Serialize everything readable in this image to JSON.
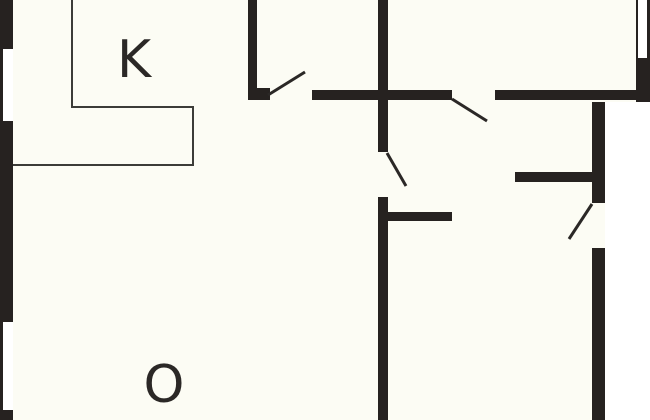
{
  "plan": {
    "title": "floor-plan",
    "canvas": {
      "width": 650,
      "height": 420
    },
    "colors": {
      "background": "#FCFCF4",
      "exterior": "#FFFFFF",
      "wall": "#262220",
      "window_fill": "#FFFFFF",
      "fixture_line": "#3C3C38",
      "door_swing": "#2B2826",
      "label_text": "#2B2826"
    },
    "rooms": [
      {
        "id": "kitchen",
        "label": "K",
        "cx": 134,
        "cy": 60
      },
      {
        "id": "living-room",
        "label": "O",
        "cx": 164,
        "cy": 385
      }
    ],
    "exterior_areas": [
      {
        "name": "outside-right",
        "x": 605,
        "y": 102,
        "w": 45,
        "h": 318
      }
    ],
    "walls": [
      {
        "name": "left-exterior-wall",
        "x": 0,
        "y": 0,
        "w": 13,
        "h": 420
      },
      {
        "name": "top-partition-wall",
        "x": 248,
        "y": 0,
        "w": 9,
        "h": 90
      },
      {
        "name": "top-partition-door-jamb",
        "x": 248,
        "y": 88,
        "w": 22,
        "h": 12
      },
      {
        "name": "center-vertical-wall-upper",
        "x": 378,
        "y": 0,
        "w": 10,
        "h": 152
      },
      {
        "name": "center-vertical-wall-lower",
        "x": 378,
        "y": 197,
        "w": 10,
        "h": 223
      },
      {
        "name": "hall-horizontal-wall-left",
        "x": 312,
        "y": 90,
        "w": 140,
        "h": 10
      },
      {
        "name": "hall-horizontal-wall-right",
        "x": 495,
        "y": 90,
        "w": 155,
        "h": 10
      },
      {
        "name": "right-exterior-wall-top",
        "x": 636,
        "y": 0,
        "w": 14,
        "h": 102
      },
      {
        "name": "right-exterior-wall-upper",
        "x": 592,
        "y": 102,
        "w": 13,
        "h": 101
      },
      {
        "name": "right-exterior-wall-lower",
        "x": 592,
        "y": 248,
        "w": 13,
        "h": 172
      },
      {
        "name": "bedroom-wall-right",
        "x": 515,
        "y": 172,
        "w": 77,
        "h": 10
      },
      {
        "name": "bedroom-wall-left",
        "x": 388,
        "y": 212,
        "w": 64,
        "h": 9
      }
    ],
    "windows": [
      {
        "name": "window-left-upper",
        "x": 3,
        "y": 49,
        "w": 10,
        "h": 72
      },
      {
        "name": "window-left-lower",
        "x": 3,
        "y": 322,
        "w": 10,
        "h": 88
      },
      {
        "name": "window-top-right",
        "x": 638,
        "y": 0,
        "w": 9,
        "h": 58
      }
    ],
    "fixtures": [
      {
        "name": "counter-edge-left",
        "x": 71,
        "y": 0,
        "w": 2,
        "h": 108
      },
      {
        "name": "counter-edge-top",
        "x": 71,
        "y": 106,
        "w": 123,
        "h": 2
      },
      {
        "name": "counter-edge-right",
        "x": 192,
        "y": 106,
        "w": 2,
        "h": 60
      },
      {
        "name": "counter-edge-bottom",
        "x": 13,
        "y": 164,
        "w": 181,
        "h": 2
      }
    ],
    "door_swings": [
      {
        "name": "door-swing-top-room",
        "x1": 268,
        "y1": 95,
        "x2": 305,
        "y2": 72
      },
      {
        "name": "door-swing-hall-right",
        "x1": 452,
        "y1": 99,
        "x2": 487,
        "y2": 121
      },
      {
        "name": "door-swing-hall-lower",
        "x1": 387,
        "y1": 153,
        "x2": 406,
        "y2": 186
      },
      {
        "name": "door-swing-entrance",
        "x1": 592,
        "y1": 204,
        "x2": 569,
        "y2": 239
      }
    ]
  }
}
